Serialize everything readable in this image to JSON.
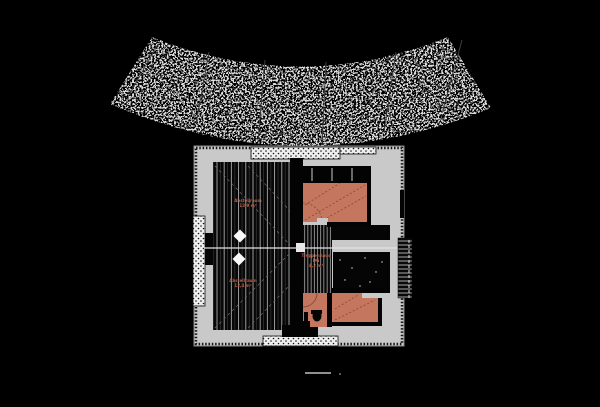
{
  "colors": {
    "background": "#000000",
    "slab": "#c9c9c9",
    "room_fill_salmon": "#c4765e",
    "room_dash": "#7c4433",
    "label_text": "#b4604a",
    "terrain_speckle": "#b8b8b8",
    "floor_lines": "#bdbdbd"
  },
  "plan": {
    "labels": {
      "room_left_top": {
        "line1": "Abstellraum",
        "line2": "13,9 m²"
      },
      "room_left_bottom": {
        "line1": "Abstellraum",
        "line2": "12,4 m²"
      },
      "stairwell": {
        "line1": "Treppenhaus",
        "line2": "DG",
        "line3": "4,2 m²"
      }
    }
  }
}
